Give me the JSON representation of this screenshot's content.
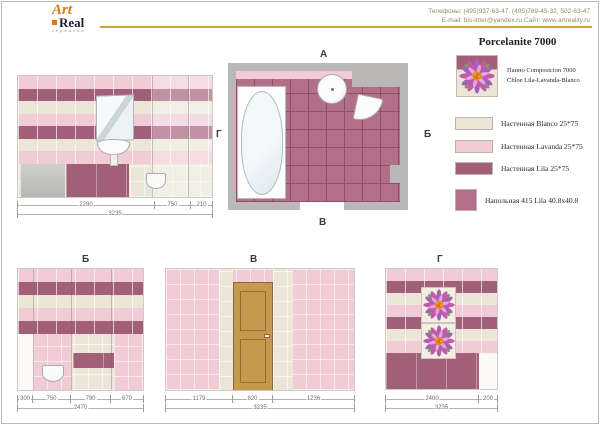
{
  "header": {
    "logo_top": "Art",
    "logo_bottom": "Real",
    "logo_sub": "керамика",
    "phones": "Телефоны: (495)937-63-47, (495)789-45-32, 502-63-47",
    "contacts2": "E-mail: bis-inter@yandex.ru    Сайт: www.artreality.ru"
  },
  "title": "Porcelanite 7000",
  "panno": {
    "line1": "Панно Composicion 7000",
    "line2": "Chloe Lila-Lavanda-Blanco"
  },
  "legend": {
    "items": [
      {
        "name": "Настенная Blanco 25*75"
      },
      {
        "name": "Настенная Lavanda 25*75"
      },
      {
        "name": "Настенная Lila 25*75"
      },
      {
        "name": "Напольная  415 Lila 40.8x40.8"
      }
    ]
  },
  "plan": {
    "label_top": "А",
    "label_right": "Б",
    "label_bottom": "В",
    "label_left": "Г"
  },
  "elev_a": {
    "dims": [
      "2280",
      "750",
      "210"
    ],
    "total": "3235"
  },
  "elev_b": {
    "label": "Б",
    "dims": [
      "300",
      "750",
      "790",
      "670"
    ],
    "total": "2470"
  },
  "elev_v": {
    "label": "В",
    "dims": [
      "1179",
      "820",
      "1236"
    ],
    "total": "3235"
  },
  "elev_g": {
    "label": "Г",
    "dims": [
      "2400",
      "200"
    ],
    "total": "3235"
  },
  "colors": {
    "blanco": "#ebe6d8",
    "lavanda": "#f1cbd5",
    "pinklight": "#f6dde3",
    "lila": "#a25f78",
    "floorlila": "#b26f8a",
    "floorgrout": "#8e5068",
    "wallgray": "#b9b8b6",
    "door": "#c69a4e",
    "gold": "#c9a243",
    "accent": "#e07818"
  }
}
